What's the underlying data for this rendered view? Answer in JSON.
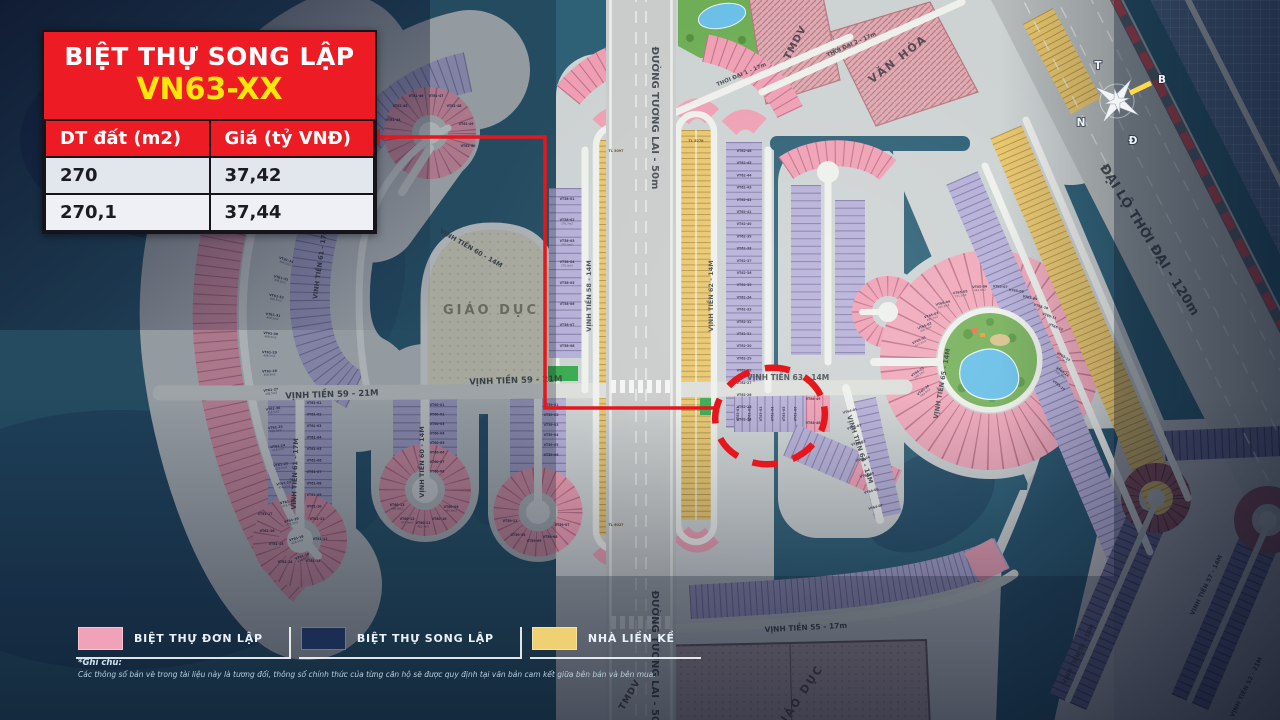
{
  "info_box": {
    "title": "BIỆT THỰ SONG LẬP",
    "code": "VN63-XX",
    "table": {
      "headers": [
        "DT đất (m2)",
        "Giá (tỷ VNĐ)"
      ],
      "rows": [
        [
          "270",
          "37,42"
        ],
        [
          "270,1",
          "37,44"
        ]
      ]
    }
  },
  "legend": {
    "items": [
      {
        "label": "BIỆT THỰ ĐƠN LẬP",
        "color": "#f0a3b8"
      },
      {
        "label": "BIỆT THỰ SONG LẬP",
        "color": "#1b2d52"
      },
      {
        "label": "NHÀ LIỀN KỀ",
        "color": "#efd173"
      }
    ]
  },
  "footnote": {
    "title": "*Ghi chú:",
    "text": "Các thông số bản vẽ trong tài liệu này là tương đối, thông số chính thức của từng căn hộ sẽ được quy định tại văn bản cam kết giữa bên bán và bên mua."
  },
  "compass": {
    "letters": [
      "T",
      "B",
      "N",
      "Đ"
    ]
  },
  "colors": {
    "water": "#2e6076",
    "land": "#cdd2d2",
    "villa_pink": "#ef9fb4",
    "villa_lavender": "#b5afd7",
    "rowhouse_yellow": "#e8c66d",
    "song_lap_navy": "#1b2d52",
    "annotation_red": "#e6161d",
    "info_red": "#ec1b24",
    "info_yellow": "#ffe70a",
    "education_beige": "#e9e6cf"
  },
  "map": {
    "road_labels": [
      {
        "t": "VỊNH TIỀN 59 - 21M",
        "x": 332,
        "y": 397,
        "r": -2,
        "s": 8.5
      },
      {
        "t": "VỊNH TIỀN 59 - 21M",
        "x": 516,
        "y": 383,
        "r": -2,
        "s": 8.5
      },
      {
        "t": "VINH TIỀN 61 - 17M",
        "x": 322,
        "y": 264,
        "r": -82,
        "s": 6.5
      },
      {
        "t": "VINH TIỀN 61 - 17M",
        "x": 297,
        "y": 474,
        "r": -88,
        "s": 6.5
      },
      {
        "t": "VỊNH TIỀN 60 - 14M",
        "x": 470,
        "y": 250,
        "r": 30,
        "s": 6.5
      },
      {
        "t": "VỊNH TIỀN 60 - 14M",
        "x": 424,
        "y": 462,
        "r": -90,
        "s": 6.5
      },
      {
        "t": "VỊNH TIỀN 58 - 14M",
        "x": 591,
        "y": 296,
        "r": -90,
        "s": 6.5
      },
      {
        "t": "VỊNH TIỀN 62 - 14M",
        "x": 713,
        "y": 296,
        "r": -90,
        "s": 6.5
      },
      {
        "t": "VỊNH TIỀN 63 - 14M",
        "x": 788,
        "y": 380,
        "r": 0,
        "s": 7.5
      },
      {
        "t": "VỊNH TIỀN 64 - 14M",
        "x": 858,
        "y": 450,
        "r": 72,
        "s": 6.5
      },
      {
        "t": "VỊNH TIỀN 65 - 14M",
        "x": 944,
        "y": 384,
        "r": -80,
        "s": 6.5
      },
      {
        "t": "VỊNH TIỀN 55 - 17m",
        "x": 806,
        "y": 630,
        "r": -3,
        "s": 7.5
      },
      {
        "t": "ĐƯỜNG TƯƠNG LAI - 50m",
        "x": 652,
        "y": 118,
        "r": 90,
        "s": 10
      },
      {
        "t": "ĐƯỜNG TƯƠNG LAI - 50m",
        "x": 652,
        "y": 662,
        "r": 90,
        "s": 10
      },
      {
        "t": "ĐẠI LỘ THỜI ĐẠI - 120m",
        "x": 1146,
        "y": 242,
        "r": 58,
        "s": 13
      },
      {
        "t": "THỜI ĐẠI 1 - 17m",
        "x": 742,
        "y": 76,
        "r": -23,
        "s": 5.5
      },
      {
        "t": "THỜI ĐẠI 2 - 17m",
        "x": 852,
        "y": 46,
        "r": -24,
        "s": 5.5
      },
      {
        "t": "VỊNH TIỀN 56 - 14M",
        "x": 1080,
        "y": 655,
        "r": -64,
        "s": 6
      },
      {
        "t": "VINH TIỀN 57 - 14M",
        "x": 1208,
        "y": 586,
        "r": -64,
        "s": 6
      },
      {
        "t": "VỊNH TIỀN 52 - 21M",
        "x": 1248,
        "y": 688,
        "r": -64,
        "s": 6
      }
    ],
    "zone_labels": [
      {
        "t": "GIÁO DỤC",
        "x": 491,
        "y": 314,
        "r": 0,
        "s": 13,
        "c": "#8f8c72",
        "ls": 3
      },
      {
        "t": "GIÁO DỤC",
        "x": 802,
        "y": 700,
        "r": -56,
        "s": 11,
        "c": "#5a4c53",
        "ls": 2
      },
      {
        "t": "VĂN HÓA",
        "x": 900,
        "y": 62,
        "r": -38,
        "s": 11,
        "c": "#554551",
        "ls": 2
      },
      {
        "t": "TMDV",
        "x": 798,
        "y": 44,
        "r": -62,
        "s": 10,
        "c": "#554551",
        "ls": 1
      },
      {
        "t": "TMDV",
        "x": 632,
        "y": 696,
        "r": -60,
        "s": 9,
        "c": "#5a4c53",
        "ls": 1
      }
    ],
    "tl_labels": [
      {
        "t": "TL 5097",
        "x": 616,
        "y": 152
      },
      {
        "t": "TL 6027",
        "x": 616,
        "y": 526
      },
      {
        "t": "TL 5278",
        "x": 696,
        "y": 142
      }
    ],
    "lot_series": {
      "vt61_arc": [
        [
          "VT61-34",
          "408.5m2"
        ],
        [
          "VT61-33",
          "408.5m2"
        ],
        [
          "VT61-32",
          "408.5m2"
        ],
        [
          "VT61-31",
          "408.5m2"
        ],
        [
          "VT61-30",
          "408.5m2"
        ],
        [
          "VT61-29",
          "408.5m2"
        ],
        [
          "VT61-28",
          "408.5m2"
        ],
        [
          "VT61-27",
          "408.5m2"
        ],
        [
          "VT61-26",
          "418.5m2"
        ],
        [
          "VT61-25",
          "418.5m2"
        ],
        [
          "VT61-24",
          "418.5m2"
        ],
        [
          "VT61-23",
          "418.5m2"
        ],
        [
          "VT61-22",
          "418.5m2"
        ],
        [
          "VT61-21",
          "418.5m2"
        ],
        [
          "VT61-20",
          "426.5m2"
        ],
        [
          "VT61-19",
          "426.5m2"
        ],
        [
          "VT61-18",
          "426.5m2"
        ]
      ],
      "vt61_col": [
        [
          "VT61-01",
          ""
        ],
        [
          "VT61-02",
          ""
        ],
        [
          "VT61-03",
          ""
        ],
        [
          "VT61-04",
          ""
        ],
        [
          "VT61-05",
          ""
        ],
        [
          "VT61-06",
          ""
        ],
        [
          "VT61-07",
          ""
        ],
        [
          "VT61-08",
          ""
        ],
        [
          "VT61-09",
          ""
        ],
        [
          "VT61-10",
          ""
        ]
      ],
      "vt61_bulb": [
        [
          "VT61-11",
          ""
        ],
        [
          "VT61-12",
          ""
        ],
        [
          "VT61-13",
          ""
        ],
        [
          "VT61-14",
          ""
        ],
        [
          "VT61-15",
          ""
        ],
        [
          "VT61-16",
          ""
        ],
        [
          "VT61-17",
          ""
        ]
      ],
      "vt61_top": [
        [
          "VT61-44",
          ""
        ],
        [
          "VT61-45",
          ""
        ],
        [
          "VT61-46",
          ""
        ],
        [
          "VT61-47",
          ""
        ],
        [
          "VT61-48",
          ""
        ],
        [
          "VT61-49",
          ""
        ],
        [
          "VT61-50",
          ""
        ]
      ],
      "vt60_col": [
        [
          "VT60-01",
          ""
        ],
        [
          "VT60-02",
          ""
        ],
        [
          "VT60-03",
          ""
        ],
        [
          "VT60-04",
          ""
        ],
        [
          "VT60-05",
          ""
        ],
        [
          "VT60-06",
          ""
        ],
        [
          "VT60-07",
          ""
        ],
        [
          "VT60-08",
          ""
        ]
      ],
      "vt60_bulb": [
        [
          "VT60-09",
          "467.6m2"
        ],
        [
          "VT60-10",
          ""
        ],
        [
          "VT60-11",
          "461.7m2"
        ],
        [
          "VT60-12",
          "477.9m2"
        ],
        [
          "VT60-13",
          "480.9m2"
        ]
      ],
      "vt59_col": [
        [
          "VT59-01",
          ""
        ],
        [
          "VT59-02",
          ""
        ],
        [
          "VT59-03",
          ""
        ],
        [
          "VT59-04",
          ""
        ],
        [
          "VT59-05",
          ""
        ],
        [
          "VT59-06",
          ""
        ]
      ],
      "vt59_bulb": [
        [
          "VT59-07",
          ""
        ],
        [
          "VT59-08",
          ""
        ],
        [
          "VT59-09",
          ""
        ],
        [
          "VT59-10",
          ""
        ],
        [
          "VT59-11",
          ""
        ]
      ],
      "vt58_col": [
        [
          "VT58-01",
          ""
        ],
        [
          "VT58-02",
          "276.7m2"
        ],
        [
          "VT58-03",
          "275.0m2"
        ],
        [
          "VT58-04",
          "276.0m2"
        ],
        [
          "VT58-05",
          ""
        ],
        [
          "VT58-06",
          ""
        ],
        [
          "VT58-07",
          ""
        ],
        [
          "VT58-08",
          ""
        ]
      ],
      "vt62_col": [
        [
          "VT62-46",
          ""
        ],
        [
          "VT62-45",
          ""
        ],
        [
          "VT62-44",
          ""
        ],
        [
          "VT62-43",
          ""
        ],
        [
          "VT62-42",
          ""
        ],
        [
          "VT62-41",
          ""
        ],
        [
          "VT62-40",
          ""
        ],
        [
          "VT62-39",
          ""
        ],
        [
          "VT62-38",
          ""
        ],
        [
          "VT62-37",
          ""
        ],
        [
          "VT62-36",
          ""
        ],
        [
          "VT62-35",
          ""
        ],
        [
          "VT62-34",
          ""
        ],
        [
          "VT62-33",
          ""
        ],
        [
          "VT62-32",
          ""
        ],
        [
          "VT62-31",
          ""
        ],
        [
          "VT62-30",
          ""
        ],
        [
          "VT62-29",
          ""
        ],
        [
          "VT62-28",
          ""
        ],
        [
          "VT62-27",
          ""
        ],
        [
          "VT62-26",
          ""
        ],
        [
          "VT62-25",
          ""
        ],
        [
          "VT62-24",
          ""
        ]
      ],
      "vt63_row": [
        [
          "VT63-01",
          ""
        ],
        [
          "VT63-02",
          ""
        ],
        [
          "VT63-03",
          ""
        ],
        [
          "VT63-04",
          ""
        ],
        [
          "VT63-05",
          ""
        ],
        [
          "VT63-06",
          ""
        ]
      ],
      "vt64_pink": [
        [
          "VT64-49",
          ""
        ],
        [
          "VT64-48",
          ""
        ]
      ],
      "vt64_col": [
        [
          "VT64-01",
          ""
        ],
        [
          "VT64-02",
          ""
        ],
        [
          "VT64-03",
          ""
        ],
        [
          "VT64-04",
          ""
        ],
        [
          "VT64-05",
          ""
        ],
        [
          "VT64-06",
          ""
        ],
        [
          "VT64-07",
          ""
        ]
      ],
      "vt65_ring": [
        [
          "VT65-01",
          "517.3m2"
        ],
        [
          "VT65-02",
          "495.5m2"
        ],
        [
          "VT65-03",
          "489.7m2"
        ],
        [
          "VT65-04",
          "495.2m2"
        ],
        [
          "VT65-05",
          "721.3m2"
        ],
        [
          "VT65-06",
          "443.5m2"
        ],
        [
          "VT65-07",
          ""
        ],
        [
          "VT65-08",
          ""
        ],
        [
          "VT65-09",
          ""
        ],
        [
          "VT65-10",
          ""
        ],
        [
          "VT65-11",
          ""
        ],
        [
          "VT65-12",
          ""
        ],
        [
          "VT65-13",
          "595.7m2"
        ],
        [
          "VT65-14",
          "596.7m2"
        ],
        [
          "VT65-15",
          ""
        ],
        [
          "VT65-25",
          "568.2m2"
        ],
        [
          "VT65-24",
          "583.4m2"
        ]
      ]
    }
  }
}
